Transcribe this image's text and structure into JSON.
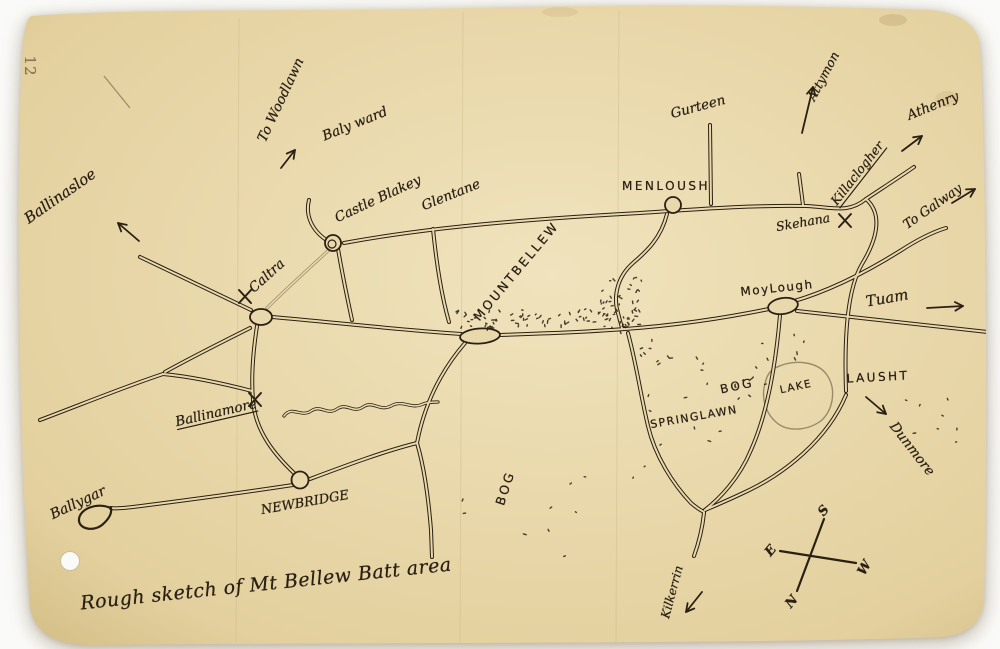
{
  "document": {
    "page_number": "12",
    "caption": "Rough sketch of Mt Bellew Batt area"
  },
  "labels": {
    "ballinasloe": "Ballinasloe",
    "to_woodlawn": "To Woodlawn",
    "ballymacward": "Baly ward",
    "castleblakeney": "Castle Blakey",
    "glentane": "Glentane",
    "gurteen": "Gurteen",
    "menlough": "MENLOUSH",
    "attymon": "Attymon",
    "killaclogher": "Killaclogher",
    "athenry": "Athenry",
    "skehana": "Skehana",
    "to_galway": "To Galway",
    "mountbellew": "MOUNTBELLEW",
    "moylough": "MoyLough",
    "tuam": "Tuam",
    "caltra": "Caltra",
    "ballinamore": "Ballinamore",
    "lake": "LAKE",
    "laught": "LAUSHT",
    "bog_upper": "BOG",
    "bog_lower": "BOG",
    "springlawn": "SPRINGLAWN",
    "newbridge": "NEWBRIDGE",
    "ballygar": "Ballygar",
    "dunmore": "Dunmore",
    "kilkerrin": "Kilkerrin"
  },
  "compass": {
    "n": "N",
    "s": "S",
    "e": "E",
    "w": "W"
  },
  "colors": {
    "paper": "#e9d8ab",
    "ink": "#2a2013",
    "faint_ink": "#9b8a68",
    "background": "#fafaf8",
    "page_number_ink": "#8b7355"
  }
}
